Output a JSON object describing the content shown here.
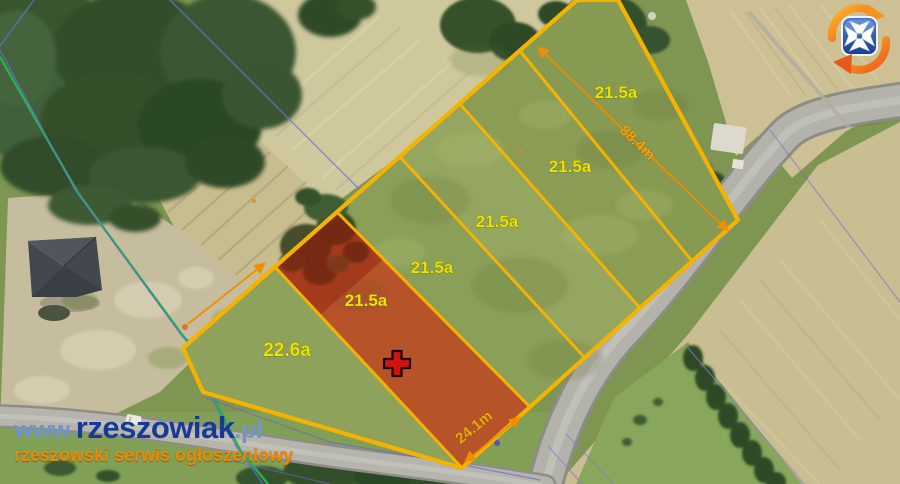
{
  "map": {
    "parcels": [
      {
        "id": "plot-1",
        "area_label": "21.5a"
      },
      {
        "id": "plot-2",
        "area_label": "21.5a"
      },
      {
        "id": "plot-3",
        "area_label": "21.5a"
      },
      {
        "id": "plot-4",
        "area_label": "21.5a"
      },
      {
        "id": "plot-5-highlighted",
        "area_label": "21.5a"
      },
      {
        "id": "plot-6",
        "area_label": "22.6a"
      }
    ],
    "measurements": {
      "length": "88.4m",
      "width": "24.1m"
    },
    "icons": {
      "logo": "rzeszowiak-crest-logo",
      "marker": "plot-location-cross-marker"
    }
  },
  "watermark": {
    "prefix": "www.",
    "brand": "rzeszowiak",
    "suffix": ".pl",
    "tagline": "rzeszowski serwis ogłoszeniowy"
  },
  "colors": {
    "parcel_outline": "#f5b301",
    "area_label": "#eae400",
    "measure_label": "#f2a60f",
    "highlight_overlay": "rgba(205,30,5,0.38)",
    "watermark_brand": "#173a96",
    "watermark_accent": "#6f94cf",
    "tagline": "#f08800"
  }
}
